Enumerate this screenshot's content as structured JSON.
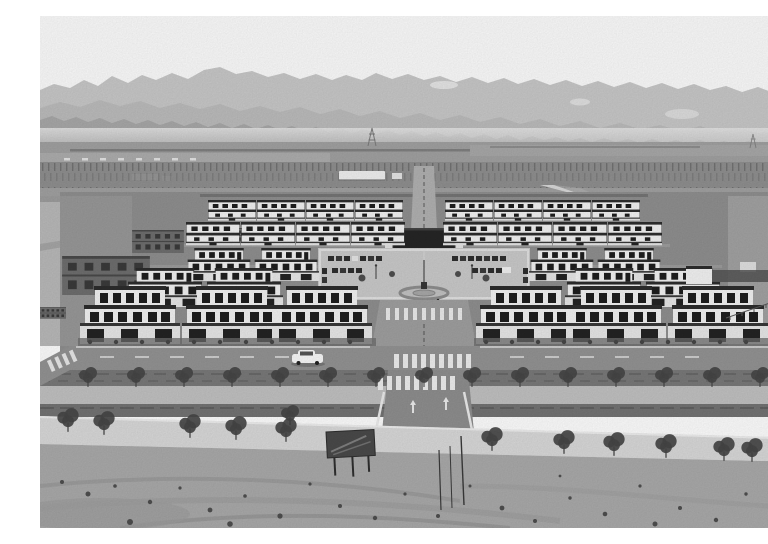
{
  "image": {
    "type": "aerial-photograph",
    "style": "black-and-white newspaper photo",
    "subject": "Aerial view of a newly built symmetric rural residential community: rows of white two-storey courtyard houses around a central plaza with flagpole and stage screen, tree-lined boulevard and bare graded earth in the foreground, farmland and layered mountain ridges in the background",
    "width": 768,
    "height": 512
  },
  "scene": {
    "background": {
      "sky": "overexposed white sky",
      "mountains": "three layered gray ridges with haze and faint snow patches",
      "plain": "flat farmland with trellis/vineyard rows, distant wall line, small sheds and power pylons",
      "greenhouse": "long white shed in the middle distance"
    },
    "midground": {
      "village": "symmetric grid of finished white houses with dark flat roofs and walled courtyards",
      "plaza": "central paved square with parking stalls, ornamental circle, flagpole, lamp posts and small trees",
      "stage_screen": "large dark screen/stage structure at the head of the plaza",
      "unfinished_buildings": "bare brick house shells on the west side",
      "diagonal_road": "bright paved road running toward the north-east corner"
    },
    "foreground": {
      "street": "asphalt street with dashed centerline, zebra crossings, corner markings and turn arrows",
      "boulevard": "hedge strip, light footpath and second hedge strip planted with young willows",
      "white_road": "light concrete road sloping toward lower right with a second row of trees",
      "dirt": "graded bare earth with tire tracks, scattered stones, a dark construction sign board and thin survey poles",
      "car": "white SUV parked on the street left of the main axis"
    }
  },
  "counts": {
    "house_rows_per_side": 5,
    "houses_left": 13,
    "houses_right": 13,
    "unfinished_buildings": 4,
    "boulevard_trees_row1": 15,
    "boulevard_trees_row2": 12,
    "parking_stalls": 26
  },
  "colors": {
    "sky": "#fdfdfd",
    "mountain_far": "#c9c9c9",
    "mountain_mid": "#bdbdbd",
    "mountain_near": "#a9a9a9",
    "plain": "#a2a2a2",
    "field_band": "#8e8e8e",
    "ground": "#909090",
    "plaza": "#cbcbcb",
    "house_wall": "#f4f4f4",
    "roof": "#2d2d2d",
    "window": "#1f1f1f",
    "courtyard_wall": "#e9e9e9",
    "gate": "#242424",
    "brick": "#6f6f6f",
    "brick_shadow": "#4a4a4a",
    "street": "#949494",
    "road_white": "#dadada",
    "marking": "#ededed",
    "hedge": "#747474",
    "grass": "#7a7a7a",
    "path": "#c2c2c2",
    "tree": "#474747",
    "sand": "#ababab",
    "pebble": "#4f4f4f",
    "screen": "#262626",
    "fence": "#555555",
    "car": "#fafafa"
  }
}
